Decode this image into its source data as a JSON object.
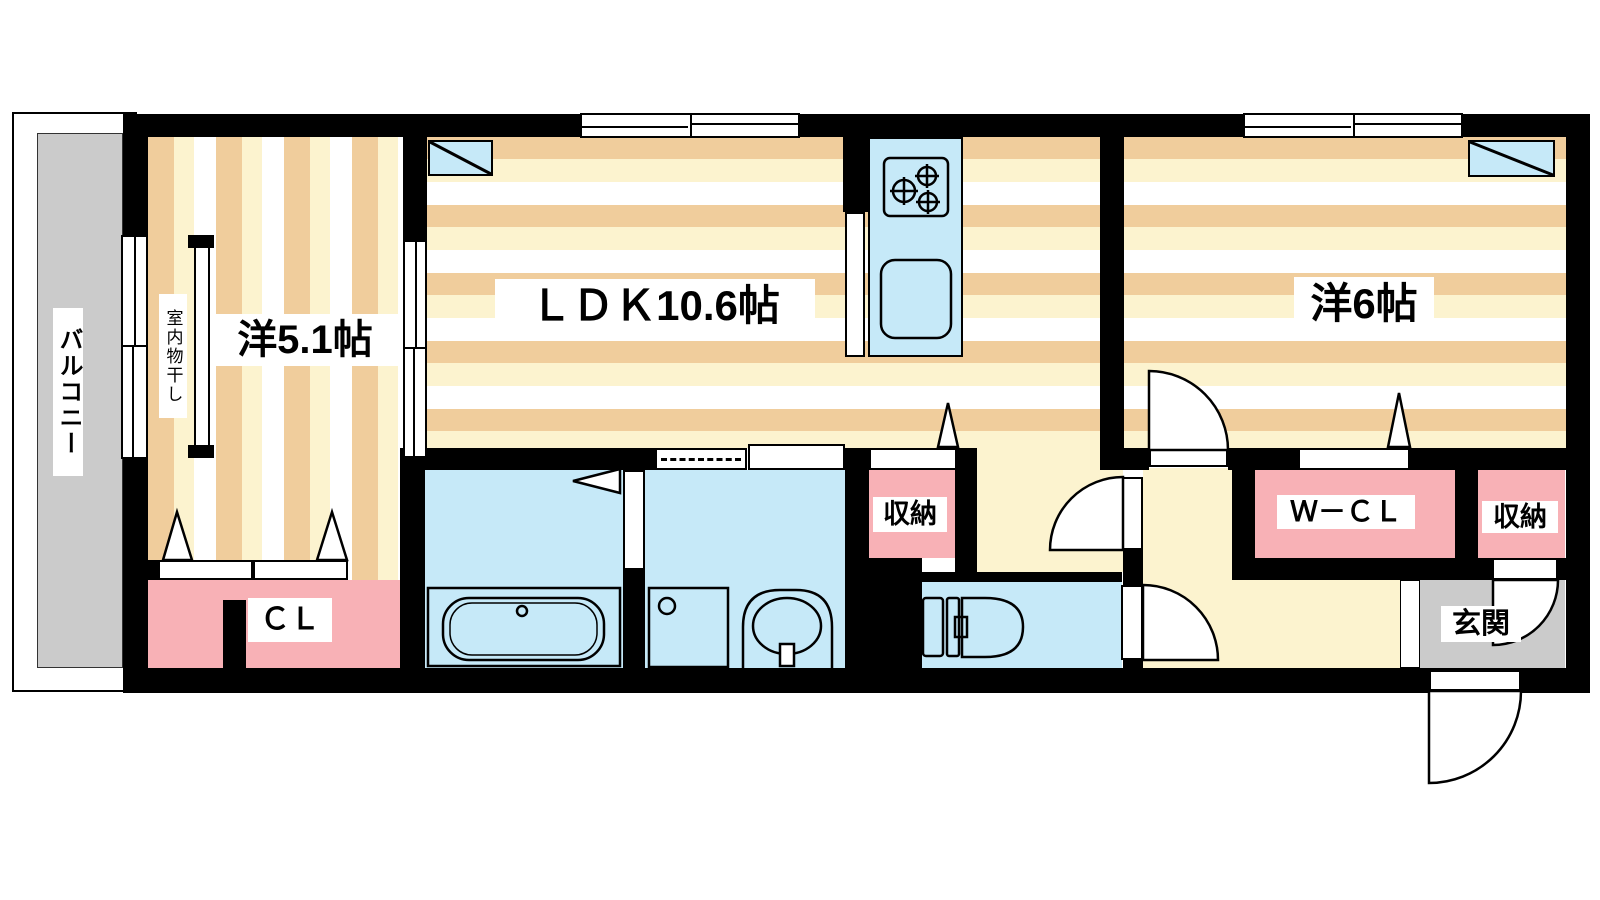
{
  "rooms": {
    "balcony": {
      "label": "バルコニー"
    },
    "west_room_small": {
      "label": "洋5.1帖"
    },
    "indoor_drying": {
      "label": "室内物干し"
    },
    "ldk": {
      "label": "ＬＤＫ10.6帖"
    },
    "west_room_large": {
      "label": "洋6帖"
    },
    "closet": {
      "label": "ＣＬ"
    },
    "storage_center": {
      "label": "収納"
    },
    "walk_in_closet": {
      "label": "Ｗ－ＣＬ"
    },
    "storage_entrance": {
      "label": "収納"
    },
    "entrance": {
      "label": "玄関"
    }
  },
  "colors": {
    "wall": "#000000",
    "stripe-tan": "#F0CD9C",
    "stripe-cream": "#FCF3CF",
    "stripe-white": "#FFFFFF",
    "hall-cream": "#FCF3CF",
    "water-blue": "#C6E9F8",
    "closet-pink": "#F8B1B6",
    "gray": "#CBCBCB",
    "label-bg": "#FFFFFF"
  }
}
